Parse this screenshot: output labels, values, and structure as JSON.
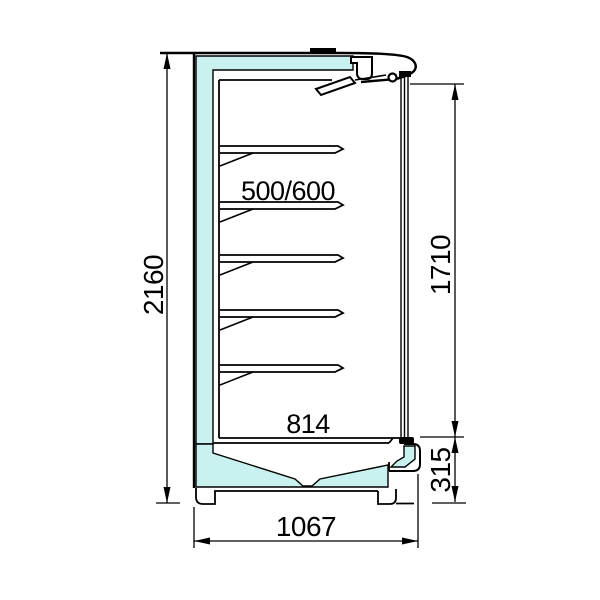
{
  "drawing": {
    "labels": {
      "overall_height": "2160",
      "display_opening_height": "1710",
      "base_height": "315",
      "inner_depth": "814",
      "overall_depth": "1067",
      "shelf_depth": "500/600"
    },
    "colors": {
      "line": "#000000",
      "insulation": "#c9f1ef",
      "background": "#ffffff"
    },
    "shelves": 5
  }
}
